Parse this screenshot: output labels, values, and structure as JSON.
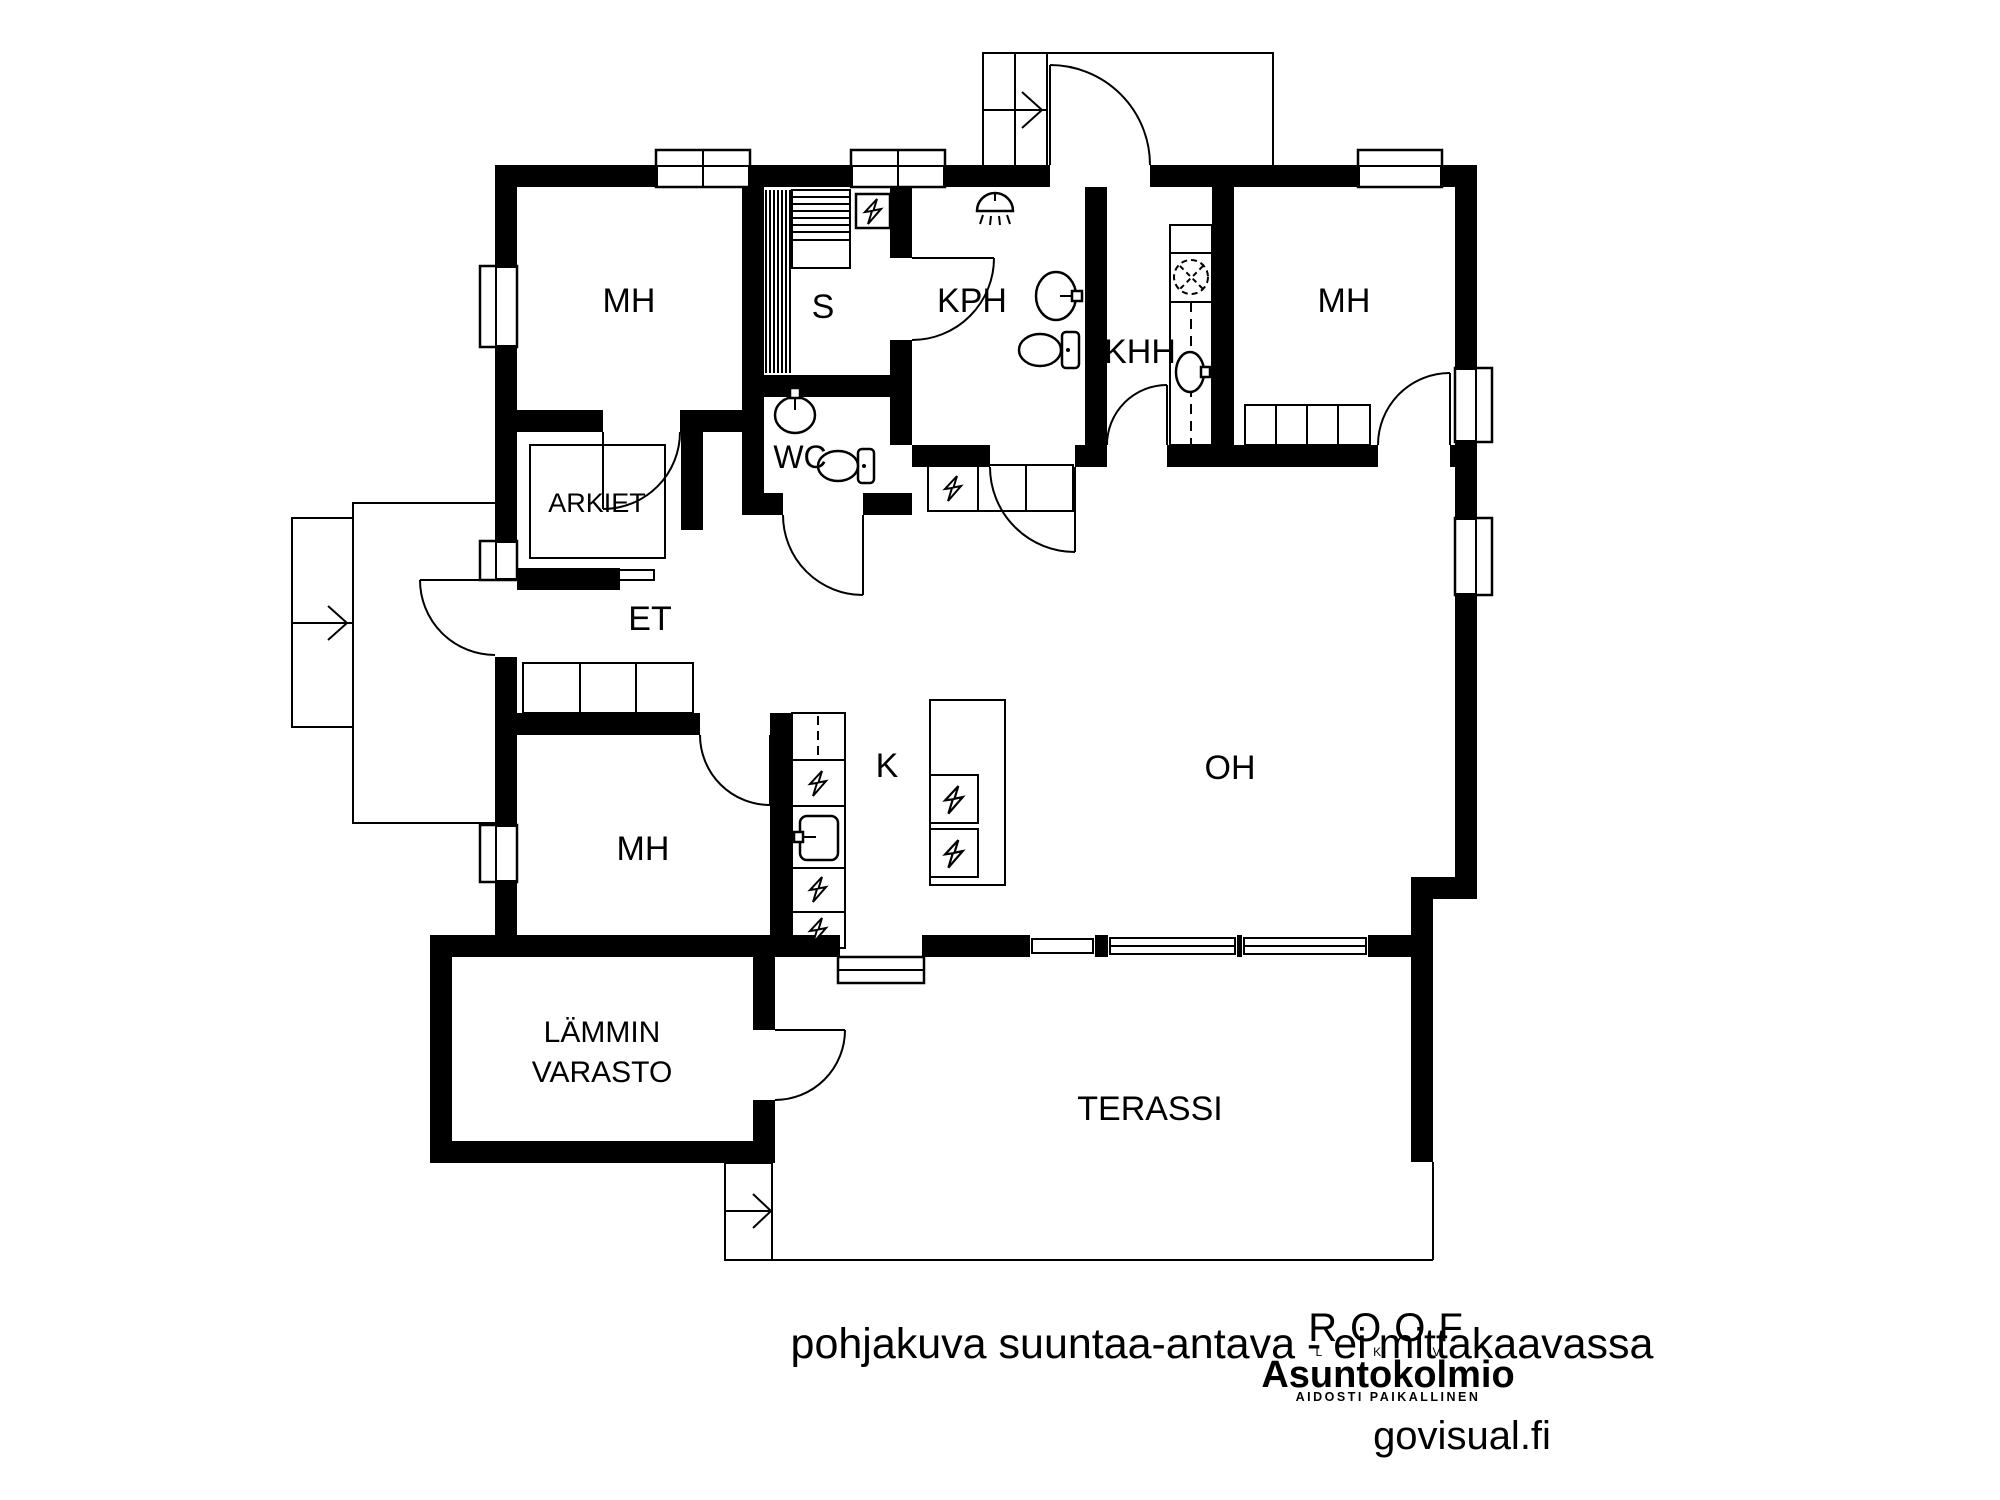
{
  "plan": {
    "disclaimer": "pohjakuva suuntaa-antava - ei mittakaavassa",
    "rooms": {
      "bedroom_top_left": "MH",
      "sauna": "S",
      "bathroom": "KPH",
      "utility_room": "KHH",
      "bedroom_top_right": "MH",
      "alcove": "ARKIET",
      "toilet_room": "WC",
      "entry_hall": "ET",
      "bedroom_bottom_left": "MH",
      "kitchen": "K",
      "living_room": "OH",
      "warm_storage_line1": "LÄMMIN",
      "warm_storage_line2": "VARASTO",
      "terrace": "TERASSI"
    },
    "colors": {
      "walls": "#000000",
      "disclaimer_text": "#ababab"
    },
    "icons": {
      "lightning": "electrical-appliance",
      "shower": "ceiling-shower",
      "sink": "washbasin",
      "toilet": "wc-seat",
      "washer": "washing-machine",
      "arrow": "entry-direction"
    }
  },
  "branding": {
    "roof_logo": "ROOF",
    "roof_sub": "L K V",
    "agency": "Asuntokolmio",
    "agency_tagline": "AIDOSTI PAIKALLINEN",
    "agency_color": "#339597",
    "watermark": "govisual.fi",
    "watermark_color": "#9c9c9c"
  }
}
